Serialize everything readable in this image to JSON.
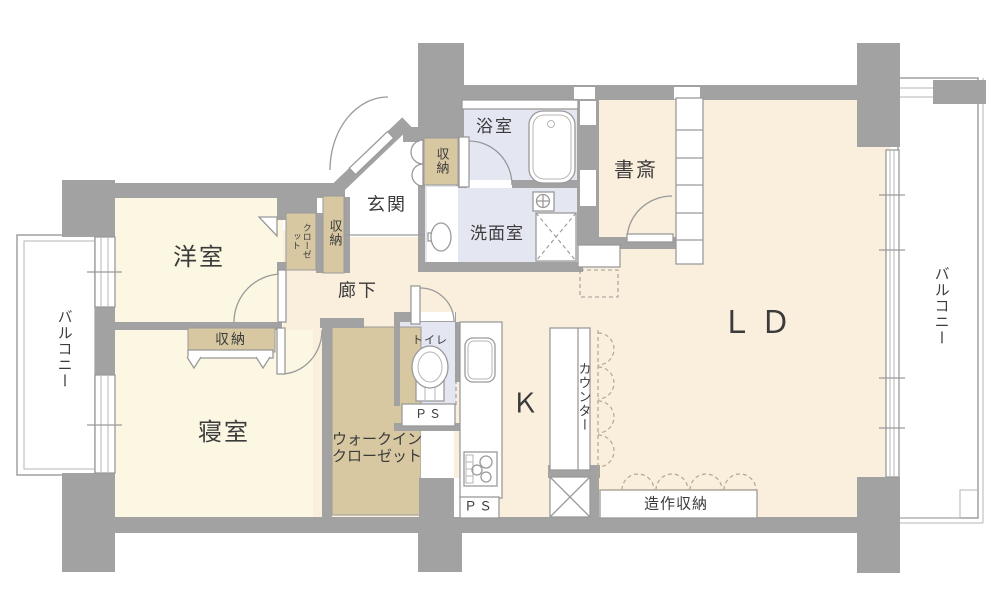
{
  "title": "マンション間取り図",
  "colors": {
    "wall": "#a2a2a2",
    "room_cream": "#fbf7e2",
    "room_peach": "#faeedd",
    "room_wet": "#e4e6f2",
    "storage_tan": "#d7c8a2",
    "outline": "#9a9a9a",
    "scallop_dash": "#b5a98c",
    "text": "#3b3b3b"
  },
  "rooms": {
    "living_dining": "ＬＤ",
    "kitchen": "Ｋ",
    "western_room": "洋室",
    "bedroom": "寝室",
    "entrance": "玄関",
    "hallway": "廊下",
    "bathroom": "浴室",
    "washroom": "洗面室",
    "toilet": "トイレ",
    "study": "書斎",
    "walk_in_closet_line1": "ウォークイン",
    "walk_in_closet_line2": "クローゼット",
    "counter": "カウンター",
    "built_in_storage": "造作収納",
    "closet": "クローゼット",
    "storage_entrance": "収納",
    "storage_hallway": "収納",
    "storage_bedroom": "収納",
    "balcony_left": "バルコニー",
    "balcony_right": "バルコニー",
    "pipe_space_toilet": "ＰＳ",
    "pipe_space_kitchen": "ＰＳ"
  }
}
